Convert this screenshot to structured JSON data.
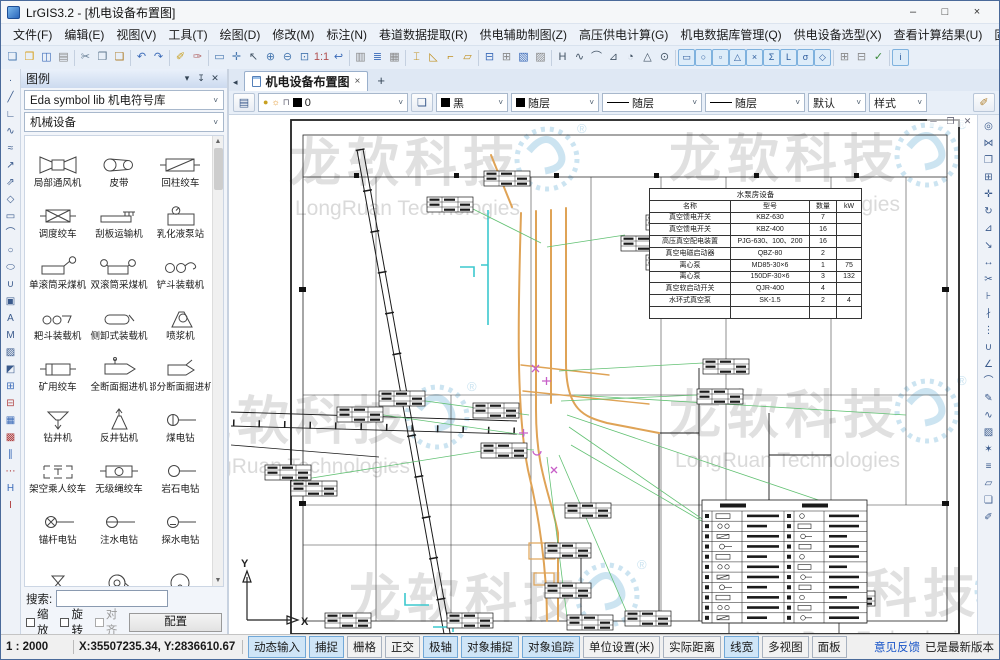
{
  "window": {
    "title": "LrGIS3.2 - [机电设备布置图]"
  },
  "window_controls": {
    "minimize": "–",
    "maximize": "□",
    "close": "×"
  },
  "menubar": {
    "items": [
      {
        "id": "file",
        "label": "文件(F)"
      },
      {
        "id": "edit",
        "label": "编辑(E)"
      },
      {
        "id": "view",
        "label": "视图(V)"
      },
      {
        "id": "tools",
        "label": "工具(T)"
      },
      {
        "id": "draw",
        "label": "绘图(D)"
      },
      {
        "id": "modify",
        "label": "修改(M)"
      },
      {
        "id": "annotate",
        "label": "标注(N)"
      },
      {
        "id": "roadway-data",
        "label": "巷道数据提取(R)"
      },
      {
        "id": "power-draft",
        "label": "供电辅助制图(Z)"
      },
      {
        "id": "hv-calc",
        "label": "高压供电计算(G)"
      },
      {
        "id": "mech-db",
        "label": "机电数据库管理(Q)"
      },
      {
        "id": "power-equip",
        "label": "供电设备选型(X)"
      },
      {
        "id": "view-results",
        "label": "查看计算结果(U)"
      },
      {
        "id": "fixed-equip",
        "label": "固定及运输设备选型(Y)"
      },
      {
        "id": "help",
        "label": "帮助(H)"
      }
    ]
  },
  "toolbar": {
    "icons": [
      "new",
      "open",
      "save",
      "print-preview",
      "cut",
      "copy",
      "paste",
      "undo",
      "redo",
      "format-brush",
      "clean-brush",
      "zoom-window",
      "pan",
      "select",
      "zoom-in",
      "zoom-out",
      "zoom-extents",
      "zoom-1-1",
      "previous-view",
      "roadway-extract-1",
      "roadway-extract-2",
      "roadway-extract-3",
      "belt-layout",
      "slope-layout",
      "lifting-layout",
      "tank-layout",
      "power-draft-1",
      "power-draft-2",
      "power-draft-3",
      "power-draft-4",
      "fixed-equip-1",
      "fixed-equip-2",
      "fixed-equip-3",
      "fixed-equip-4",
      "fixed-equip-5",
      "fixed-equip-6",
      "fixed-equip-7",
      "result-rect",
      "result-circle",
      "result-square",
      "result-triangle",
      "result-x",
      "result-sigma",
      "result-corner",
      "result-sigma2",
      "result-diamond",
      "multi-view-1",
      "multi-view-2",
      "apply-check",
      "info"
    ]
  },
  "left_toolbar": {
    "icons": [
      "point",
      "line",
      "polyline",
      "spline",
      "sketch",
      "ray",
      "construction-line",
      "polygon",
      "rectangle",
      "arc",
      "circle",
      "ellipse",
      "revision-cloud",
      "image",
      "text",
      "mtext",
      "hatch",
      "gradient-hatch",
      "insert-block",
      "create-block",
      "block-attribute",
      "block-edit",
      "align",
      "path-array",
      "h-beam",
      "i-beam"
    ]
  },
  "right_toolbar": {
    "icons": [
      "select-similar",
      "mirror",
      "copy-object",
      "array",
      "move",
      "rotate",
      "scale",
      "stretch",
      "lengthen",
      "trim",
      "extend",
      "break",
      "break-at-point",
      "join",
      "chamfer",
      "fillet",
      "edit-polyline",
      "edit-spline",
      "edit-hatch",
      "explode",
      "offset",
      "wipeout",
      "draworder",
      "style-brush"
    ]
  },
  "tabbar": {
    "tabs": [
      {
        "label": "机电设备布置图"
      }
    ],
    "new_tab_label": "+"
  },
  "properties_bar": {
    "layer": "0",
    "color": "黑",
    "color_mode": "随层",
    "linetype": "随层",
    "lineweight": "随层",
    "plot_style": "默认",
    "text_style": "样式"
  },
  "legend_panel": {
    "title": "图例",
    "library": "Eda symbol lib 机电符号库",
    "category": "机械设备",
    "symbols": [
      "局部通风机",
      "皮带",
      "回柱绞车",
      "调度绞车",
      "刮板运输机",
      "乳化液泵站",
      "单滚筒采煤机",
      "双滚筒采煤机",
      "铲斗装载机",
      "耙斗装载机",
      "侧卸式装载机",
      "喷浆机",
      "矿用绞车",
      "全断面掘进机",
      "部分断面掘进机",
      "钻井机",
      "反井钻机",
      "煤电钻",
      "架空乘人绞车",
      "无级绳绞车",
      "岩石电钻",
      "锚杆电钻",
      "注水电钻",
      "探水电钻",
      "",
      "",
      ""
    ],
    "search_label": "搜索:",
    "options": [
      {
        "id": "scale",
        "label": "缩放",
        "checked": false,
        "disabled": false
      },
      {
        "id": "rotate",
        "label": "旋转",
        "checked": false,
        "disabled": false
      },
      {
        "id": "align",
        "label": "对齐",
        "checked": false,
        "disabled": true
      }
    ],
    "config_button": "配置"
  },
  "canvas": {
    "pump_table": {
      "title": "水泵房设备",
      "headers": [
        "名称",
        "型号",
        "数量",
        "kW"
      ],
      "rows": [
        [
          "真空馈电开关",
          "KBZ-630",
          "7",
          ""
        ],
        [
          "真空馈电开关",
          "KBZ-400",
          "16",
          ""
        ],
        [
          "高压真空配电装置",
          "PJG-630、100、200",
          "16",
          ""
        ],
        [
          "真空电磁启动器",
          "QBZ-80",
          "2",
          ""
        ],
        [
          "离心泵",
          "MD85-30×6",
          "1",
          "75"
        ],
        [
          "离心泵",
          "150DF-30×6",
          "3",
          "132"
        ],
        [
          "真空软启动开关",
          "QJR-400",
          "4",
          ""
        ],
        [
          "水环式真空泵",
          "SK-1.5",
          "2",
          "4"
        ],
        [
          "",
          "",
          "",
          ""
        ]
      ]
    },
    "ucs": {
      "x_label": "X",
      "y_label": "Y"
    },
    "watermark": {
      "text": "龙软科技",
      "subtext": "LongRuan Technologies",
      "registered": "®"
    },
    "mdi_controls": {
      "minimize": "─",
      "restore": "❐",
      "close": "✕"
    }
  },
  "statusbar": {
    "scale": "1 : 2000",
    "coordinates": "X:35507235.34, Y:2836610.67",
    "toggles": [
      {
        "id": "dynamic-input",
        "label": "动态输入",
        "active": true
      },
      {
        "id": "snap",
        "label": "捕捉",
        "active": true
      },
      {
        "id": "grid",
        "label": "栅格",
        "active": false
      },
      {
        "id": "ortho",
        "label": "正交",
        "active": false
      },
      {
        "id": "polar",
        "label": "极轴",
        "active": true
      },
      {
        "id": "object-snap",
        "label": "对象捕捉",
        "active": true
      },
      {
        "id": "object-track",
        "label": "对象追踪",
        "active": true
      },
      {
        "id": "units-meter",
        "label": "单位设置(米)",
        "active": false
      },
      {
        "id": "real-distance",
        "label": "实际距离",
        "active": false
      },
      {
        "id": "lineweight",
        "label": "线宽",
        "active": true
      },
      {
        "id": "multi-view",
        "label": "多视图",
        "active": false
      },
      {
        "id": "panel",
        "label": "面板",
        "active": false
      }
    ],
    "feedback_link": "意见反馈",
    "version_status": "已是最新版本"
  },
  "colors": {
    "roadway_orange": "#dfa356",
    "pipeline_cyan": "#3cc8ce",
    "leader_green": "#62c173",
    "symbol_magenta": "#c75fc8",
    "watermark_gray": "#e0e0e0",
    "watermark_blue": "#cce4f1",
    "toggle_active_bg": "#cfe5f7"
  }
}
